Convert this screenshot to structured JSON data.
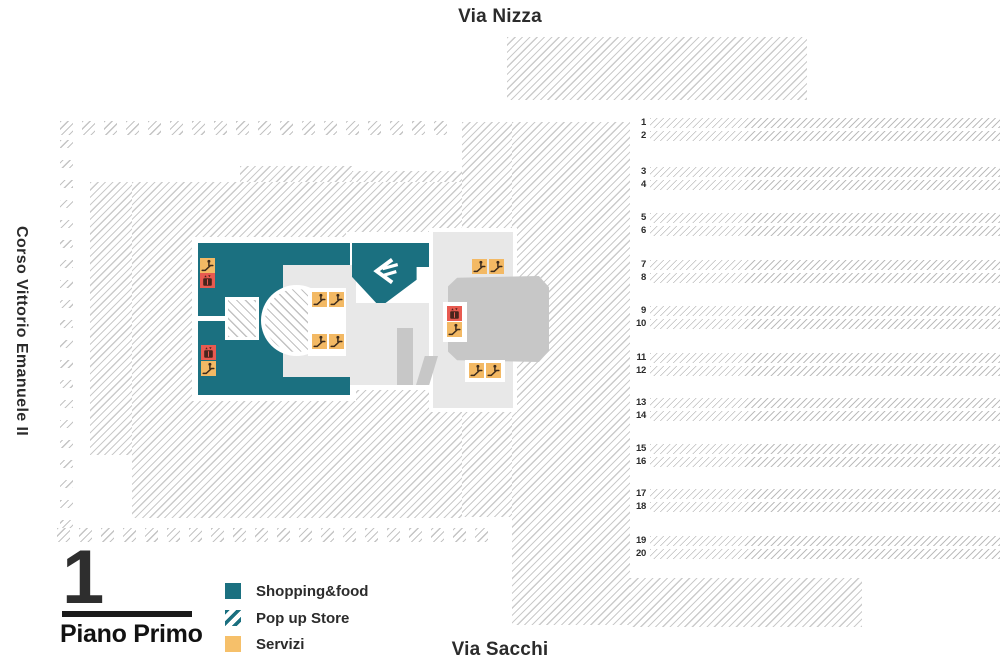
{
  "streets": {
    "top": "Via Nizza",
    "left": "Corso Vittorio Emanuele II",
    "bottom": "Via Sacchi"
  },
  "floor": {
    "number": "1",
    "label": "Piano Primo"
  },
  "legend": {
    "items": [
      {
        "id": "shopping",
        "label": "Shopping&food",
        "swatch": "solid-teal"
      },
      {
        "id": "popup",
        "label": "Pop up Store",
        "swatch": "striped-teal"
      },
      {
        "id": "servizi",
        "label": "Servizi",
        "swatch": "solid-yellow"
      }
    ]
  },
  "platforms": {
    "numbers": [
      "1",
      "2",
      "3",
      "4",
      "5",
      "6",
      "7",
      "8",
      "9",
      "10",
      "11",
      "12",
      "13",
      "14",
      "15",
      "16",
      "17",
      "18",
      "19",
      "20"
    ]
  },
  "map_icons": [
    {
      "type": "escalator",
      "x": 200,
      "y": 258
    },
    {
      "type": "elevator",
      "x": 200,
      "y": 273
    },
    {
      "type": "elevator",
      "x": 201,
      "y": 345
    },
    {
      "type": "escalator",
      "x": 201,
      "y": 361
    },
    {
      "type": "escalator",
      "x": 312,
      "y": 292
    },
    {
      "type": "escalator",
      "x": 329,
      "y": 292
    },
    {
      "type": "escalator",
      "x": 312,
      "y": 334
    },
    {
      "type": "escalator",
      "x": 329,
      "y": 334
    },
    {
      "type": "escalator",
      "x": 472,
      "y": 259
    },
    {
      "type": "escalator",
      "x": 489,
      "y": 259
    },
    {
      "type": "elevator",
      "x": 447,
      "y": 306
    },
    {
      "type": "escalator",
      "x": 447,
      "y": 322
    },
    {
      "type": "escalator",
      "x": 469,
      "y": 363
    },
    {
      "type": "escalator",
      "x": 486,
      "y": 363
    }
  ],
  "colors": {
    "shopping_teal": "#1b7080",
    "servizi_yellow": "#f6c06a",
    "elevator_red": "#e85a50",
    "hatch_gray": "#c9c9c9",
    "floor_light_gray": "#e8e8e8",
    "floor_mid_gray": "#c7c7c7",
    "text": "#2b2b2b"
  }
}
